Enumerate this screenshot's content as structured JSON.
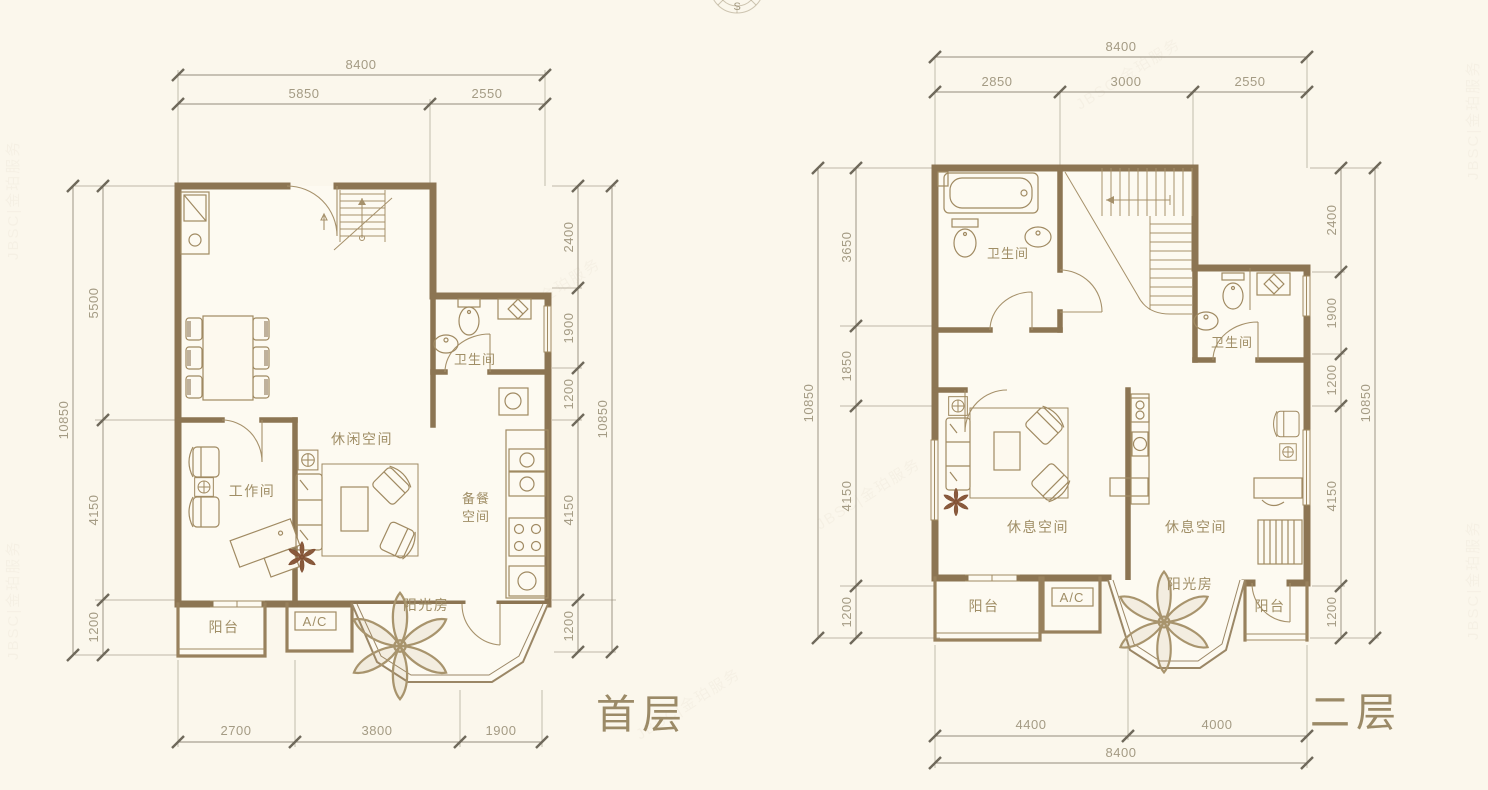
{
  "compass": {
    "south": "S"
  },
  "watermark": {
    "text": "JBSC|金珀服务"
  },
  "p1": {
    "title": "首层",
    "dims": {
      "t_total": "8400",
      "t1": "5850",
      "t2": "2550",
      "l_total": "10850",
      "l1": "5500",
      "l2": "4150",
      "l3": "1200",
      "r1": "2400",
      "r2": "1900",
      "r3": "1200",
      "r4": "4150",
      "r5": "1200",
      "r_total": "10850",
      "b1": "2700",
      "b2": "3800",
      "b3": "1900"
    },
    "rooms": {
      "work": "工作间",
      "leisure": "休闲空间",
      "bath": "卫生间",
      "pantry1": "备餐",
      "pantry2": "空间",
      "balcony": "阳台",
      "ac": "A/C",
      "sunroom": "阳光房"
    }
  },
  "p2": {
    "title": "二层",
    "dims": {
      "t_total": "8400",
      "t1": "2850",
      "t2": "3000",
      "t3": "2550",
      "l_total": "10850",
      "l1": "3650",
      "l2": "1850",
      "l3": "4150",
      "l4": "1200",
      "r1": "2400",
      "r2": "1900",
      "r3": "1200",
      "r4": "4150",
      "r5": "1200",
      "r_total": "10850",
      "b1": "4400",
      "b2": "4000",
      "b_total": "8400"
    },
    "rooms": {
      "bath_top": "卫生间",
      "bath_right": "卫生间",
      "rest_left": "休息空间",
      "rest_right": "休息空间",
      "balcony_left": "阳台",
      "ac": "A/C",
      "sunroom": "阳光房",
      "balcony_right": "阳台"
    }
  }
}
